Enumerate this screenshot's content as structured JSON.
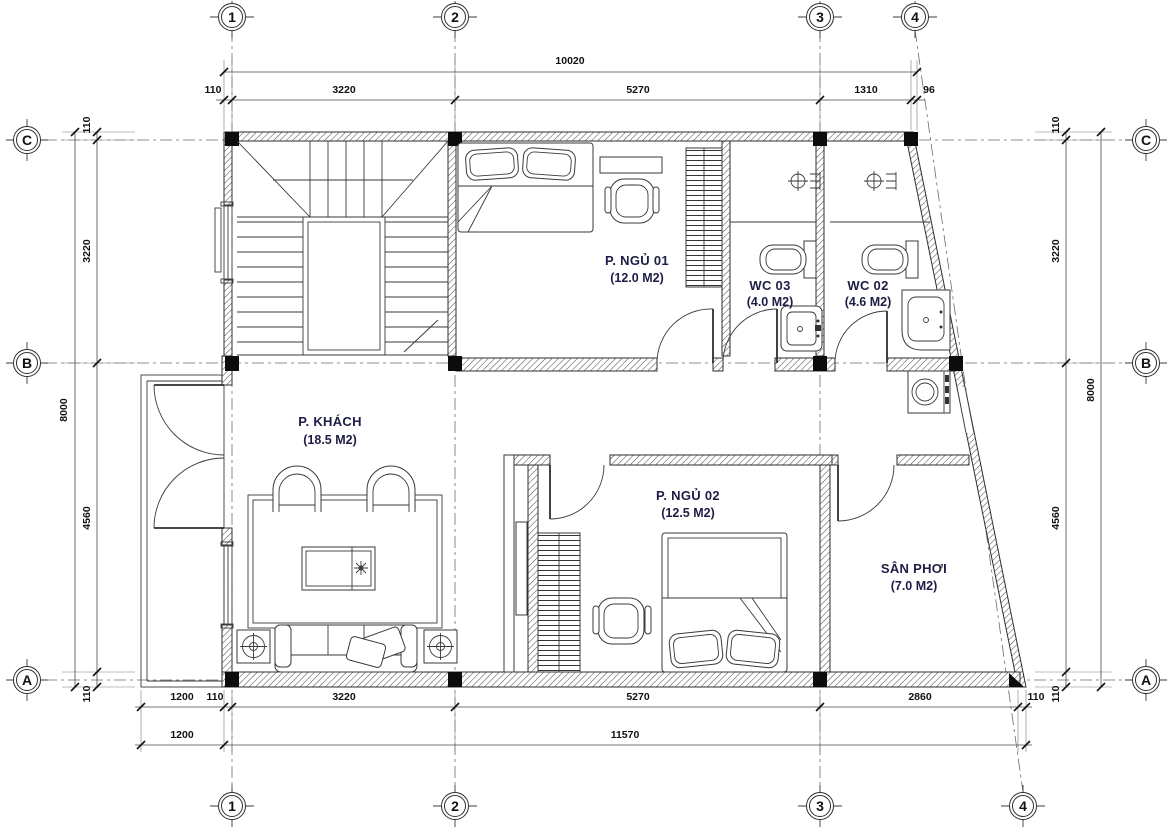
{
  "drawing": {
    "grid": {
      "columns": [
        "1",
        "2",
        "3",
        "4"
      ],
      "rows": [
        "C",
        "B",
        "A"
      ]
    },
    "rooms": [
      {
        "id": "bedroom-1",
        "name": "P. NGỦ 01",
        "area": "(12.0 M2)"
      },
      {
        "id": "wc-3",
        "name": "WC 03",
        "area": "(4.0 M2)"
      },
      {
        "id": "wc-2",
        "name": "WC 02",
        "area": "(4.6 M2)"
      },
      {
        "id": "living-room",
        "name": "P. KHÁCH",
        "area": "(18.5 M2)"
      },
      {
        "id": "bedroom-2",
        "name": "P. NGỦ 02",
        "area": "(12.5 M2)"
      },
      {
        "id": "drying-yard",
        "name": "SÂN PHƠI",
        "area": "(7.0 M2)"
      }
    ],
    "dimensions": {
      "top": {
        "total": "10020",
        "chain": [
          "110",
          "3220",
          "5270",
          "1310",
          "96"
        ]
      },
      "bottom": {
        "chain": [
          "1200",
          "110",
          "3220",
          "5270",
          "2860",
          "110"
        ],
        "overall": [
          "1200",
          "11570"
        ]
      },
      "left": {
        "total": "8000",
        "chain": [
          "110",
          "3220",
          "4560",
          "110"
        ]
      },
      "right": {
        "total": "8000",
        "chain": [
          "110",
          "3220",
          "4560",
          "110"
        ]
      }
    },
    "colors": {
      "line": "#2e2e2e",
      "label": "#1d1d45",
      "dim": "#111111"
    }
  }
}
